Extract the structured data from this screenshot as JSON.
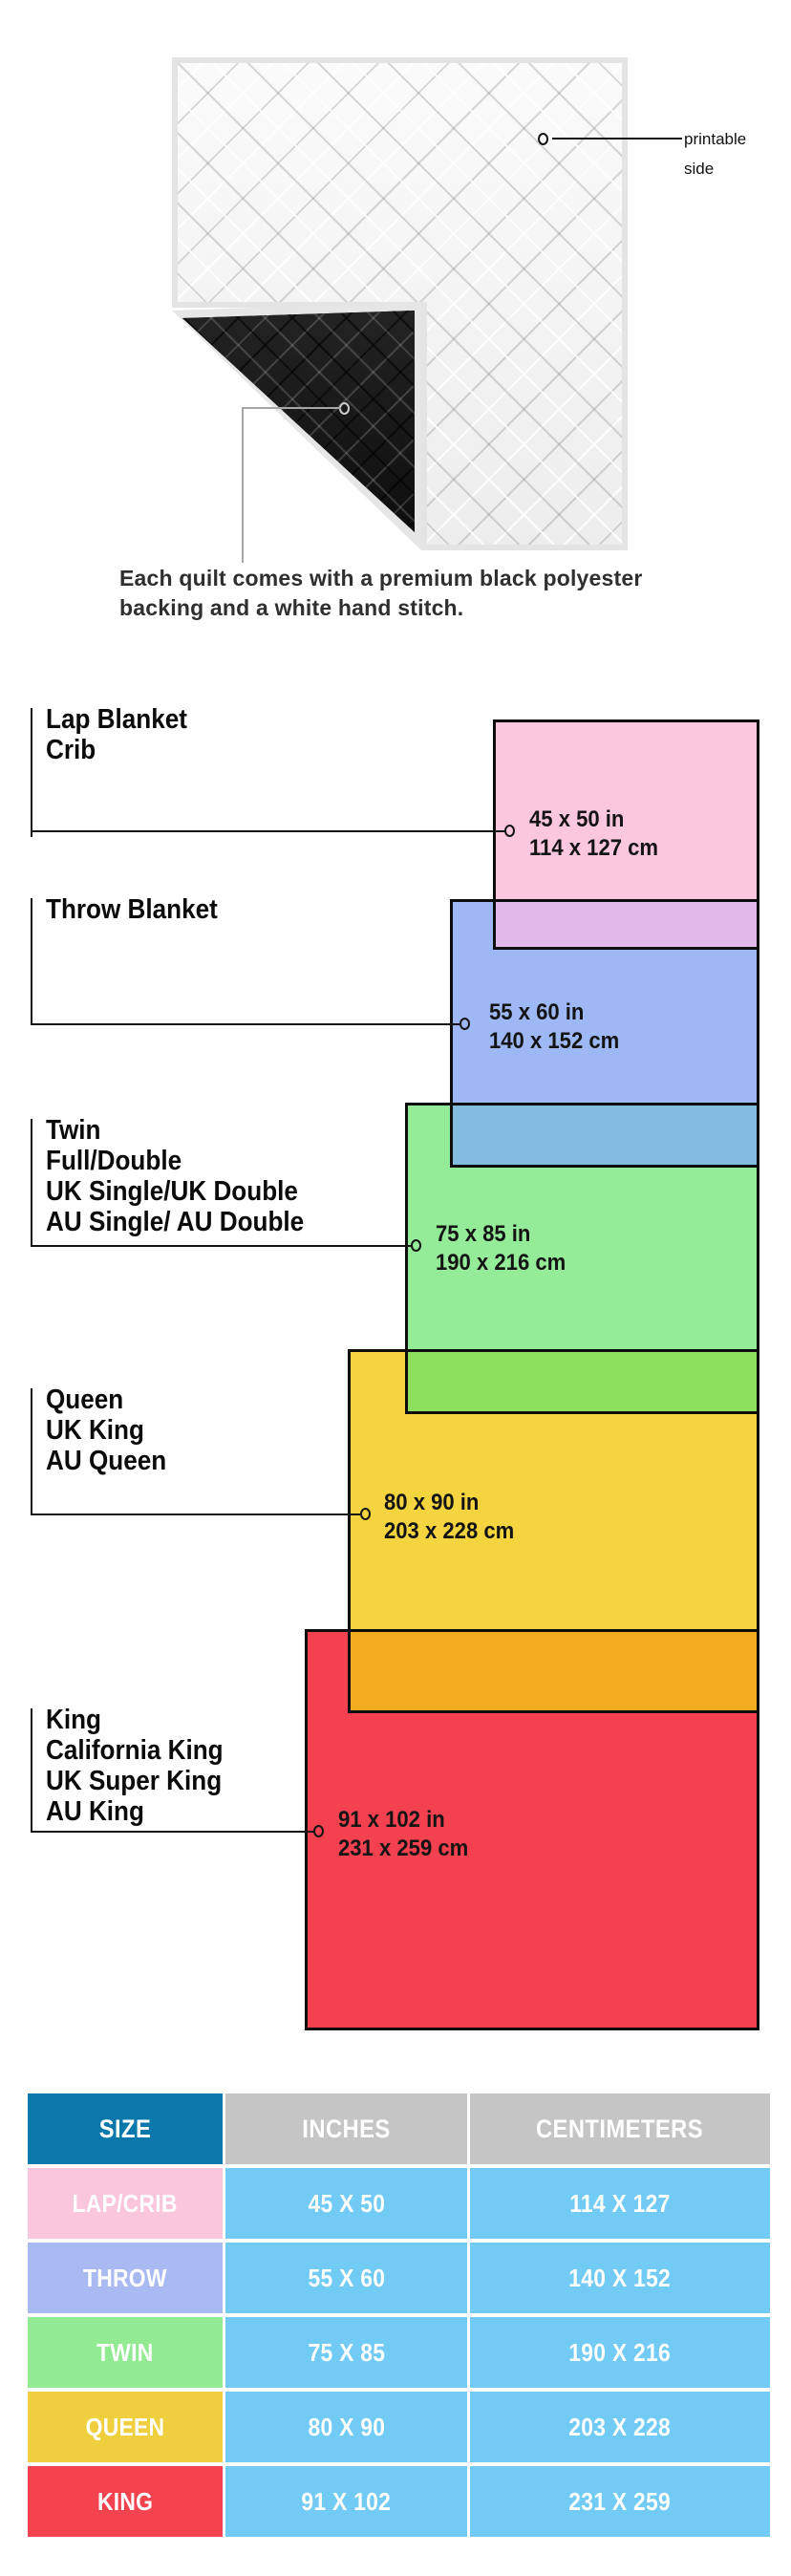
{
  "hero": {
    "printable_label_lines": [
      "printable",
      "side"
    ],
    "caption": "Each quilt comes with a premium black polyester backing and a white hand stitch."
  },
  "diagram": {
    "sizes": [
      {
        "names": [
          "Lap Blanket",
          "Crib"
        ],
        "inches": "45 x 50 in",
        "centimeters": "114 x 127 cm",
        "color": "#FBC7DF"
      },
      {
        "names": [
          "Throw Blanket"
        ],
        "inches": "55 x 60 in",
        "centimeters": "140 x 152 cm",
        "color": "#9DB8F5"
      },
      {
        "names": [
          "Twin",
          "Full/Double",
          "UK Single/UK Double",
          "AU Single/ AU Double"
        ],
        "inches": "75 x 85 in",
        "centimeters": "190 x 216 cm",
        "color": "#95EC98"
      },
      {
        "names": [
          "Queen",
          "UK King",
          "AU Queen"
        ],
        "inches": "80 x 90 in",
        "centimeters": "203 x 228 cm",
        "color": "#F4D43F"
      },
      {
        "names": [
          "King",
          "California King",
          "UK Super King",
          "AU King"
        ],
        "inches": "91 x 102 in",
        "centimeters": "231 x 259 cm",
        "color": "#F4414F"
      }
    ],
    "overlap_colors": {
      "pink_blue": "#E0B9E8",
      "blue_green": "#84BCE0",
      "green_yellow": "#8EE05F",
      "yellow_red": "#F3AC1F"
    }
  },
  "table": {
    "headers": [
      "SIZE",
      "INCHES",
      "CENTIMETERS"
    ],
    "header_colors": {
      "size": "#0B78AB",
      "other": "#C5C5C5"
    },
    "data_cell_color": "#72CBF5",
    "rows": [
      {
        "size": "LAP/CRIB",
        "inches": "45 X 50",
        "centimeters": "114 X 127",
        "color": "#F9C6DB"
      },
      {
        "size": "THROW",
        "inches": "55 X 60",
        "centimeters": "140 X 152",
        "color": "#A9BAF2"
      },
      {
        "size": "TWIN",
        "inches": "75 X 85",
        "centimeters": "190 X 216",
        "color": "#92EB92"
      },
      {
        "size": "QUEEN",
        "inches": "80 X 90",
        "centimeters": "203 X 228",
        "color": "#F0CF3E"
      },
      {
        "size": "KING",
        "inches": "91 X 102",
        "centimeters": "231 X 259",
        "color": "#F2434F"
      }
    ]
  }
}
